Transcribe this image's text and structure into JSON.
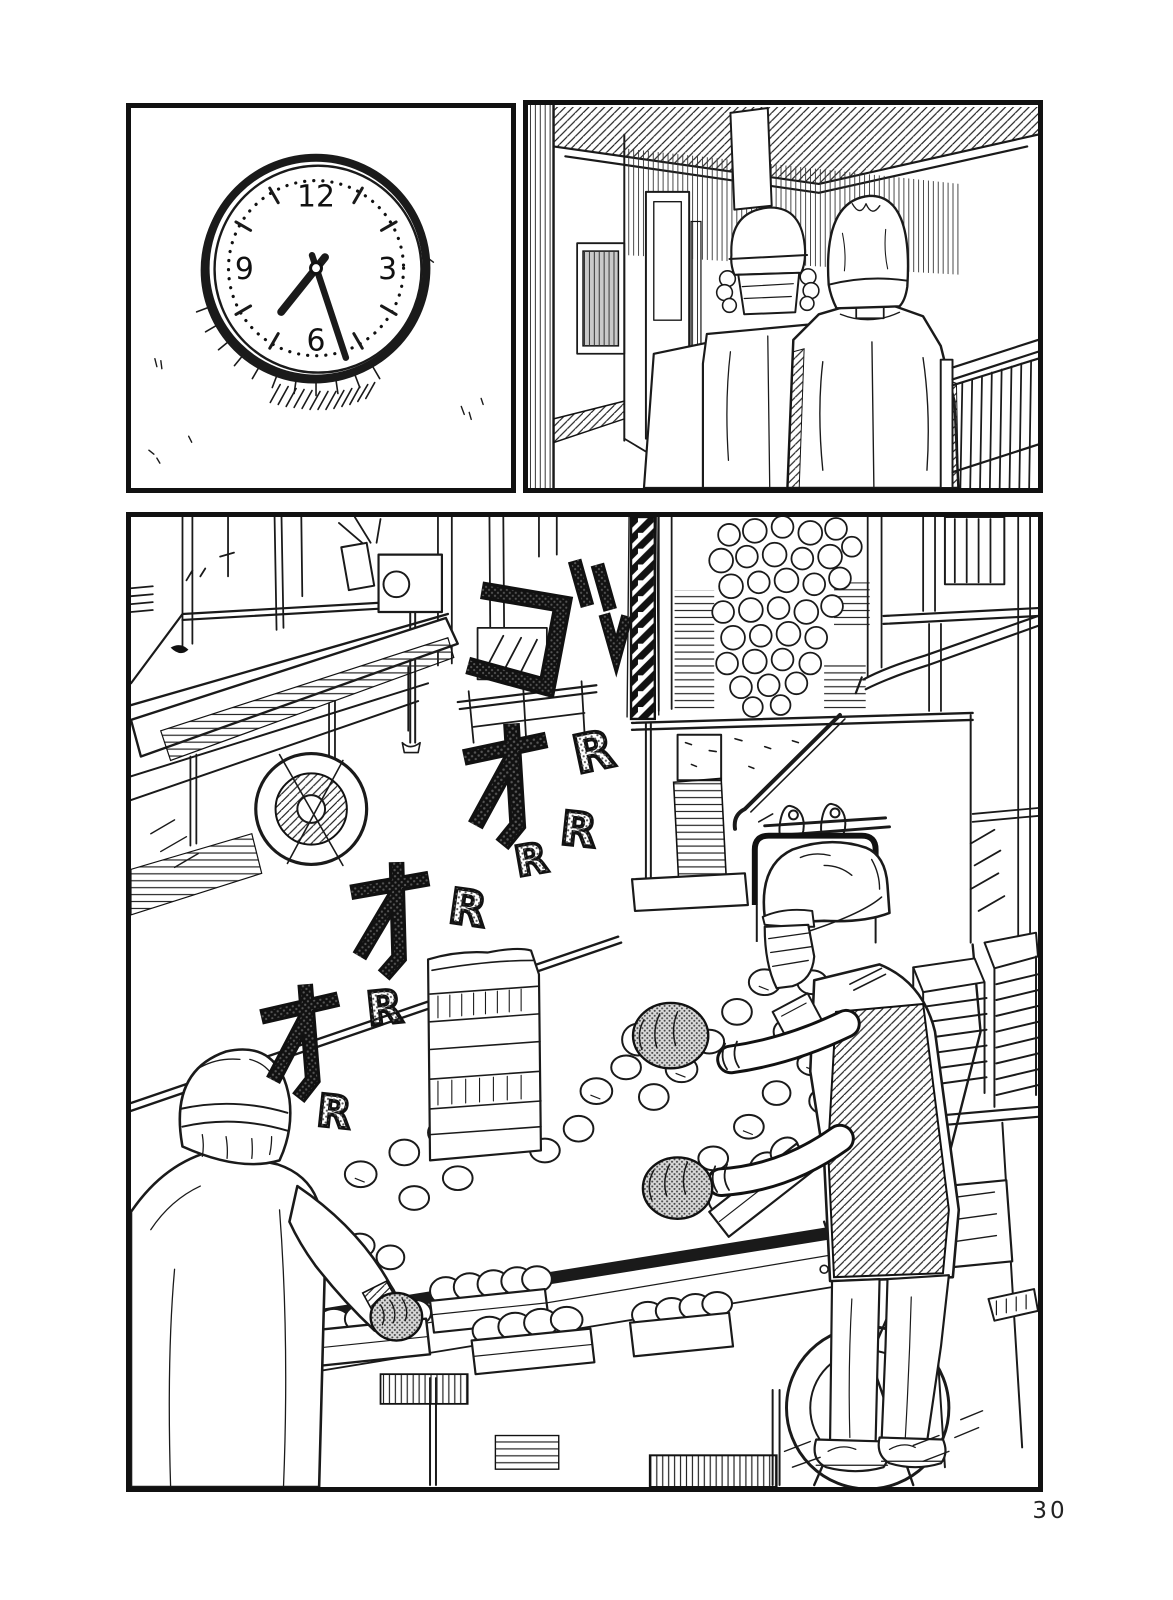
{
  "page": {
    "number": "30"
  },
  "panel1": {
    "alt": "round wall clock on a blank wall",
    "numerals": {
      "top": "12",
      "right": "3",
      "bottom": "6",
      "left": "9"
    },
    "time_shown": "about 7:25"
  },
  "panel2": {
    "alt": "three factory workers in white caps and work jackets walking away down a corridor beside a stair railing"
  },
  "panel3": {
    "alt": "bread factory floor: dough balls tumble down a chute onto a long conveyor table while two masked workers in caps sort rolls into baking tins",
    "sfx": {
      "go": "ゴ",
      "o": "オ",
      "r": "R",
      "reading": "gooooRRRR (machine rumble)"
    }
  },
  "ink": {
    "line": "#1a1a1a",
    "paper": "#ffffff",
    "tone": "#888888"
  }
}
